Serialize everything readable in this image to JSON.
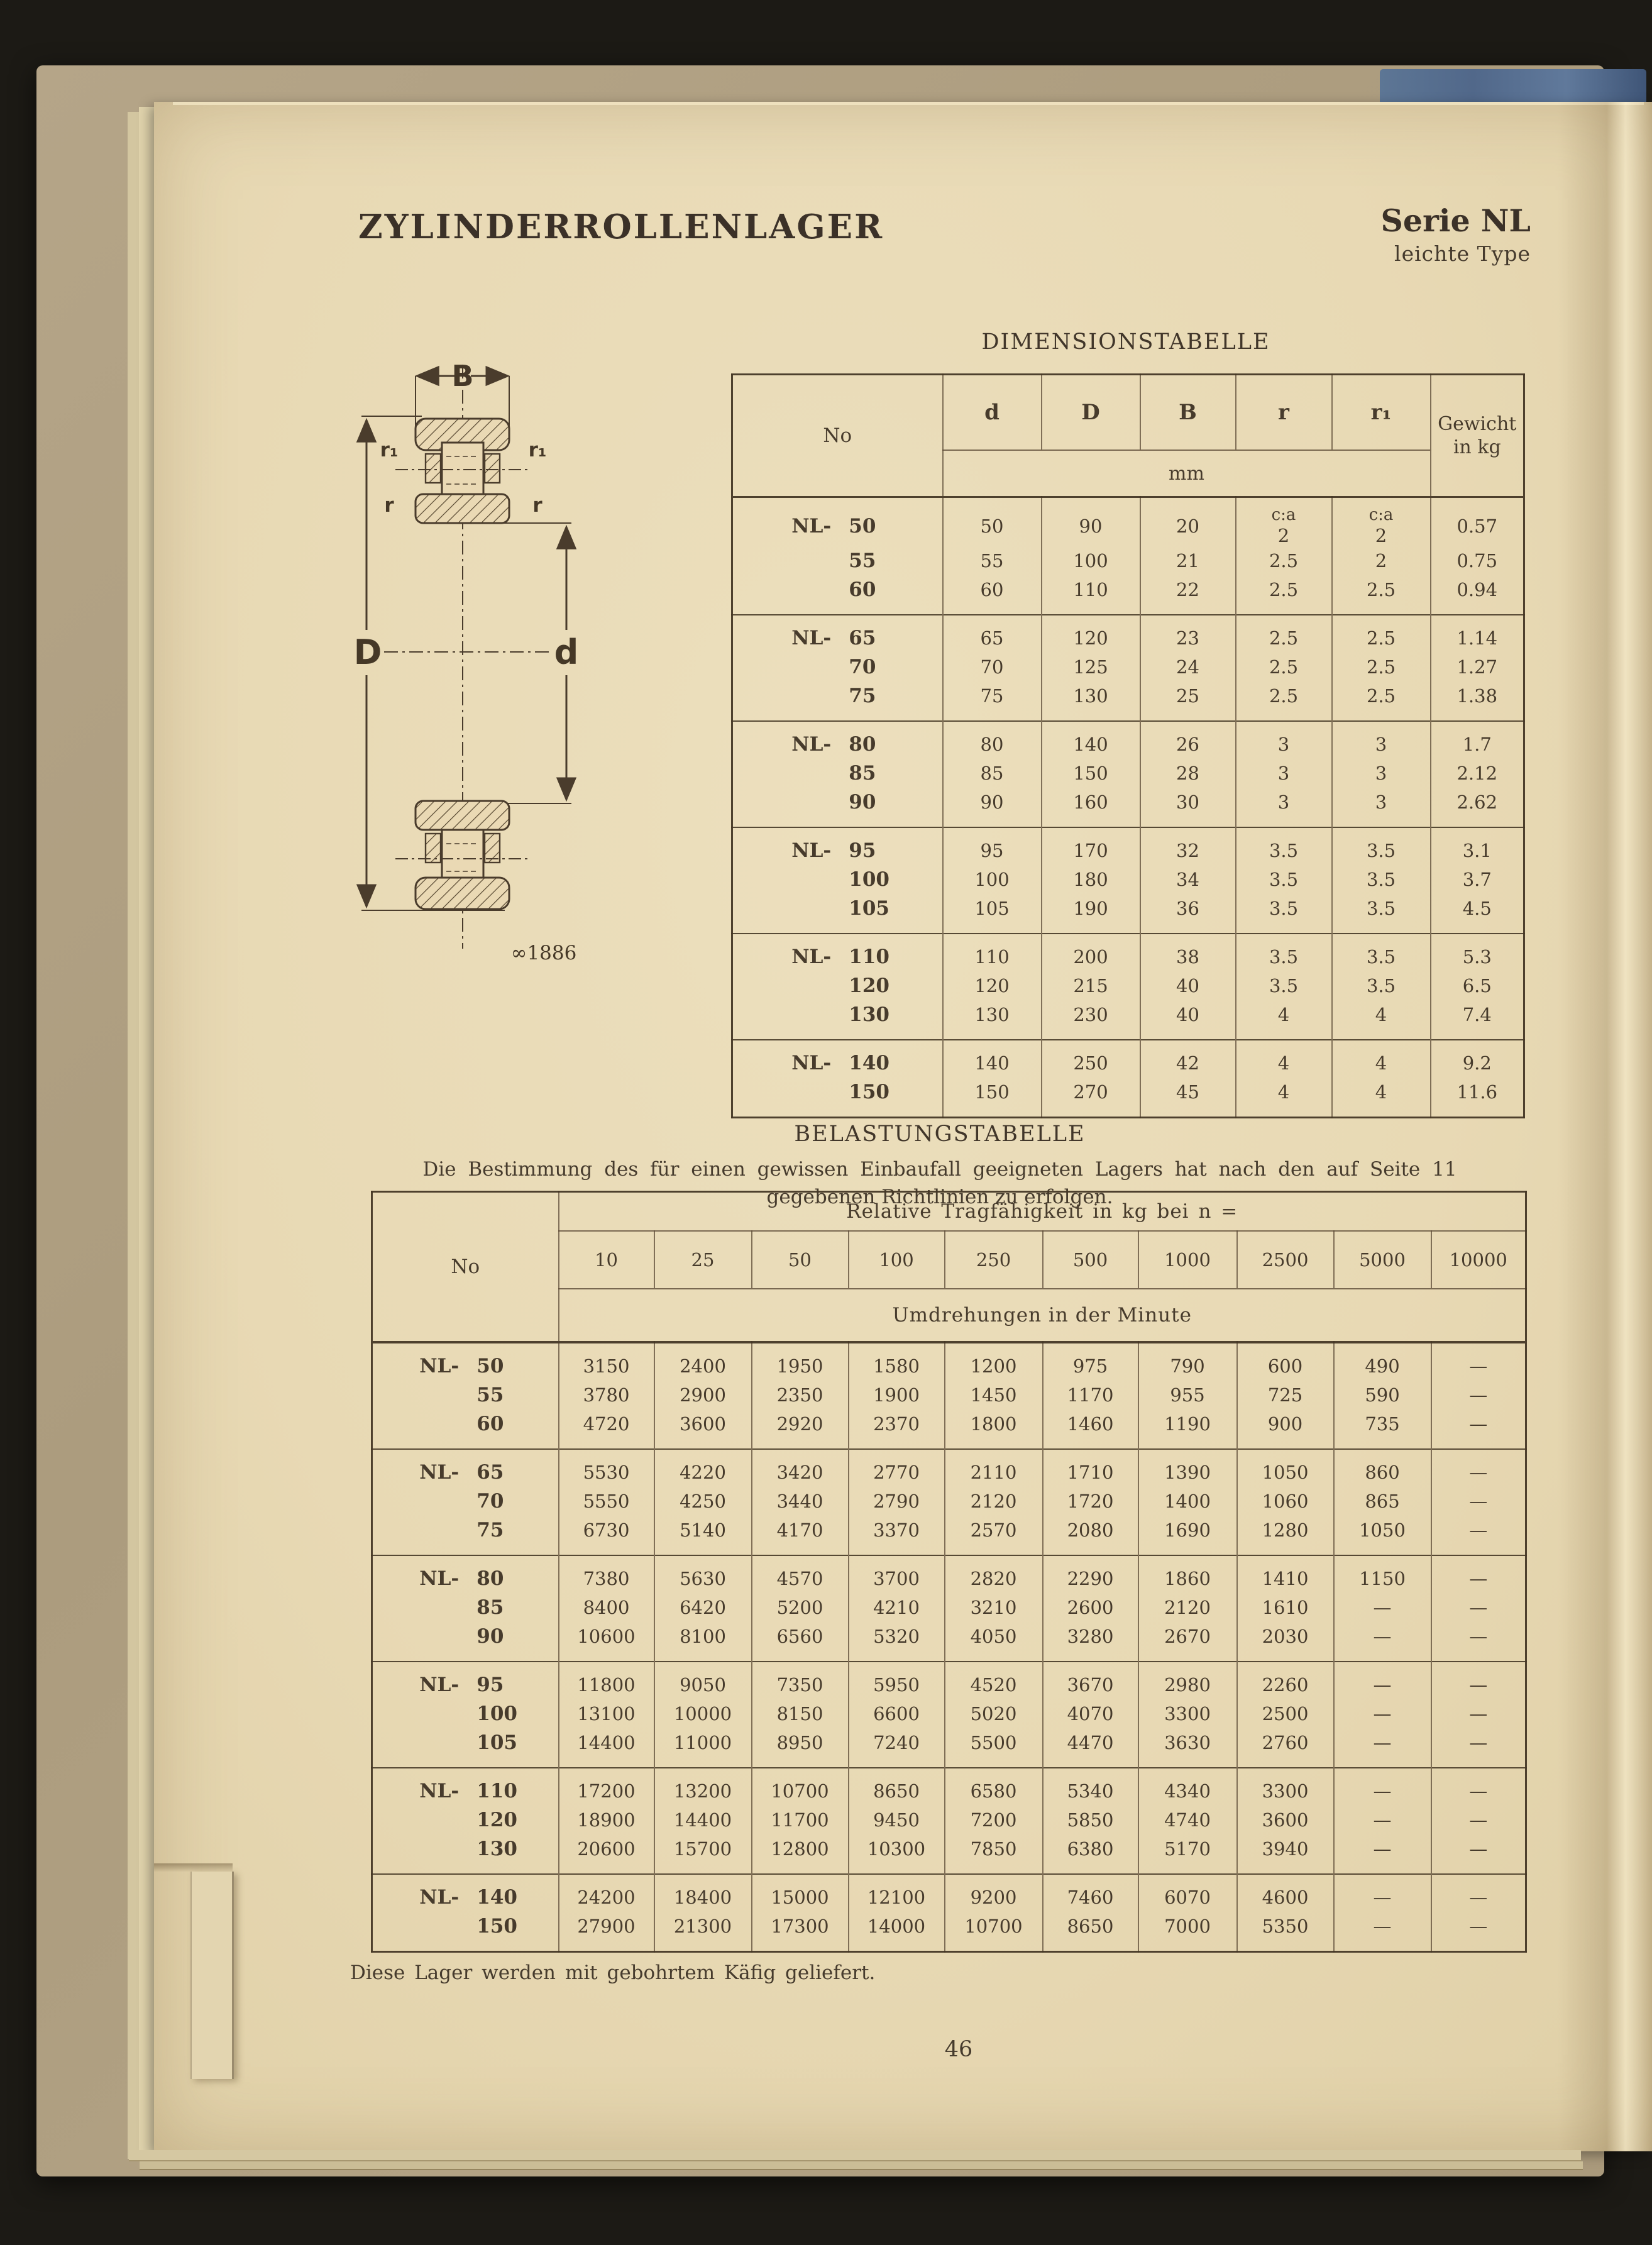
{
  "page": {
    "title": "ZYLINDERROLLENLAGER",
    "series": "Serie NL",
    "series_sub": "leichte Type",
    "footer_note": "Diese Lager werden mit gebohrtem Käfig geliefert.",
    "page_number": "46",
    "paper_color": "#e9dbb6",
    "ink_color": "#44382a",
    "cover_color": "#af9f81",
    "cover_blue_color": "#51688a"
  },
  "figure": {
    "label_B": "B",
    "label_D": "D",
    "label_d": "d",
    "label_r1": "r₁",
    "label_r": "r",
    "caption": "∞1886"
  },
  "dimension_table": {
    "heading": "DIMENSIONSTABELLE",
    "col_no": "No",
    "col_d": "d",
    "col_D": "D",
    "col_B": "B",
    "col_r": "r",
    "col_r1": "r₁",
    "col_weight": "Gewicht in kg",
    "unit_row": "mm",
    "ca_label": "c:a",
    "groups": [
      {
        "prefix": "NL-",
        "rows": [
          {
            "no": "50",
            "d": "50",
            "D": "90",
            "B": "20",
            "r": "2",
            "r1": "2",
            "g": "0.57",
            "ca": true
          },
          {
            "no": "55",
            "d": "55",
            "D": "100",
            "B": "21",
            "r": "2.5",
            "r1": "2",
            "g": "0.75"
          },
          {
            "no": "60",
            "d": "60",
            "D": "110",
            "B": "22",
            "r": "2.5",
            "r1": "2.5",
            "g": "0.94"
          }
        ]
      },
      {
        "prefix": "NL-",
        "rows": [
          {
            "no": "65",
            "d": "65",
            "D": "120",
            "B": "23",
            "r": "2.5",
            "r1": "2.5",
            "g": "1.14"
          },
          {
            "no": "70",
            "d": "70",
            "D": "125",
            "B": "24",
            "r": "2.5",
            "r1": "2.5",
            "g": "1.27"
          },
          {
            "no": "75",
            "d": "75",
            "D": "130",
            "B": "25",
            "r": "2.5",
            "r1": "2.5",
            "g": "1.38"
          }
        ]
      },
      {
        "prefix": "NL-",
        "rows": [
          {
            "no": "80",
            "d": "80",
            "D": "140",
            "B": "26",
            "r": "3",
            "r1": "3",
            "g": "1.7"
          },
          {
            "no": "85",
            "d": "85",
            "D": "150",
            "B": "28",
            "r": "3",
            "r1": "3",
            "g": "2.12"
          },
          {
            "no": "90",
            "d": "90",
            "D": "160",
            "B": "30",
            "r": "3",
            "r1": "3",
            "g": "2.62"
          }
        ]
      },
      {
        "prefix": "NL-",
        "rows": [
          {
            "no": "95",
            "d": "95",
            "D": "170",
            "B": "32",
            "r": "3.5",
            "r1": "3.5",
            "g": "3.1"
          },
          {
            "no": "100",
            "d": "100",
            "D": "180",
            "B": "34",
            "r": "3.5",
            "r1": "3.5",
            "g": "3.7"
          },
          {
            "no": "105",
            "d": "105",
            "D": "190",
            "B": "36",
            "r": "3.5",
            "r1": "3.5",
            "g": "4.5"
          }
        ]
      },
      {
        "prefix": "NL-",
        "rows": [
          {
            "no": "110",
            "d": "110",
            "D": "200",
            "B": "38",
            "r": "3.5",
            "r1": "3.5",
            "g": "5.3"
          },
          {
            "no": "120",
            "d": "120",
            "D": "215",
            "B": "40",
            "r": "3.5",
            "r1": "3.5",
            "g": "6.5"
          },
          {
            "no": "130",
            "d": "130",
            "D": "230",
            "B": "40",
            "r": "4",
            "r1": "4",
            "g": "7.4"
          }
        ]
      },
      {
        "prefix": "NL-",
        "rows": [
          {
            "no": "140",
            "d": "140",
            "D": "250",
            "B": "42",
            "r": "4",
            "r1": "4",
            "g": "9.2"
          },
          {
            "no": "150",
            "d": "150",
            "D": "270",
            "B": "45",
            "r": "4",
            "r1": "4",
            "g": "11.6"
          }
        ]
      }
    ]
  },
  "load_table": {
    "heading": "BELASTUNGSTABELLE",
    "intro_lines": [
      "Die Bestimmung des für einen gewissen Einbaufall geeigneten Lagers hat nach den auf Seite 11",
      "gegebenen Richtlinien zu erfolgen."
    ],
    "col_no": "No",
    "span_header": "Relative Tragfähigkeit in kg bei n =",
    "speed_cols": [
      "10",
      "25",
      "50",
      "100",
      "250",
      "500",
      "1000",
      "2500",
      "5000",
      "10000"
    ],
    "sub_header": "Umdrehungen in der Minute",
    "dash": "—",
    "groups": [
      {
        "prefix": "NL-",
        "rows": [
          {
            "no": "50",
            "v": [
              "3150",
              "2400",
              "1950",
              "1580",
              "1200",
              "975",
              "790",
              "600",
              "490",
              "—"
            ]
          },
          {
            "no": "55",
            "v": [
              "3780",
              "2900",
              "2350",
              "1900",
              "1450",
              "1170",
              "955",
              "725",
              "590",
              "—"
            ]
          },
          {
            "no": "60",
            "v": [
              "4720",
              "3600",
              "2920",
              "2370",
              "1800",
              "1460",
              "1190",
              "900",
              "735",
              "—"
            ]
          }
        ]
      },
      {
        "prefix": "NL-",
        "rows": [
          {
            "no": "65",
            "v": [
              "5530",
              "4220",
              "3420",
              "2770",
              "2110",
              "1710",
              "1390",
              "1050",
              "860",
              "—"
            ]
          },
          {
            "no": "70",
            "v": [
              "5550",
              "4250",
              "3440",
              "2790",
              "2120",
              "1720",
              "1400",
              "1060",
              "865",
              "—"
            ]
          },
          {
            "no": "75",
            "v": [
              "6730",
              "5140",
              "4170",
              "3370",
              "2570",
              "2080",
              "1690",
              "1280",
              "1050",
              "—"
            ]
          }
        ]
      },
      {
        "prefix": "NL-",
        "rows": [
          {
            "no": "80",
            "v": [
              "7380",
              "5630",
              "4570",
              "3700",
              "2820",
              "2290",
              "1860",
              "1410",
              "1150",
              "—"
            ]
          },
          {
            "no": "85",
            "v": [
              "8400",
              "6420",
              "5200",
              "4210",
              "3210",
              "2600",
              "2120",
              "1610",
              "—",
              "—"
            ]
          },
          {
            "no": "90",
            "v": [
              "10600",
              "8100",
              "6560",
              "5320",
              "4050",
              "3280",
              "2670",
              "2030",
              "—",
              "—"
            ]
          }
        ]
      },
      {
        "prefix": "NL-",
        "rows": [
          {
            "no": "95",
            "v": [
              "11800",
              "9050",
              "7350",
              "5950",
              "4520",
              "3670",
              "2980",
              "2260",
              "—",
              "—"
            ]
          },
          {
            "no": "100",
            "v": [
              "13100",
              "10000",
              "8150",
              "6600",
              "5020",
              "4070",
              "3300",
              "2500",
              "—",
              "—"
            ]
          },
          {
            "no": "105",
            "v": [
              "14400",
              "11000",
              "8950",
              "7240",
              "5500",
              "4470",
              "3630",
              "2760",
              "—",
              "—"
            ]
          }
        ]
      },
      {
        "prefix": "NL-",
        "rows": [
          {
            "no": "110",
            "v": [
              "17200",
              "13200",
              "10700",
              "8650",
              "6580",
              "5340",
              "4340",
              "3300",
              "—",
              "—"
            ]
          },
          {
            "no": "120",
            "v": [
              "18900",
              "14400",
              "11700",
              "9450",
              "7200",
              "5850",
              "4740",
              "3600",
              "—",
              "—"
            ]
          },
          {
            "no": "130",
            "v": [
              "20600",
              "15700",
              "12800",
              "10300",
              "7850",
              "6380",
              "5170",
              "3940",
              "—",
              "—"
            ]
          }
        ]
      },
      {
        "prefix": "NL-",
        "rows": [
          {
            "no": "140",
            "v": [
              "24200",
              "18400",
              "15000",
              "12100",
              "9200",
              "7460",
              "6070",
              "4600",
              "—",
              "—"
            ]
          },
          {
            "no": "150",
            "v": [
              "27900",
              "21300",
              "17300",
              "14000",
              "10700",
              "8650",
              "7000",
              "5350",
              "—",
              "—"
            ]
          }
        ]
      }
    ]
  }
}
